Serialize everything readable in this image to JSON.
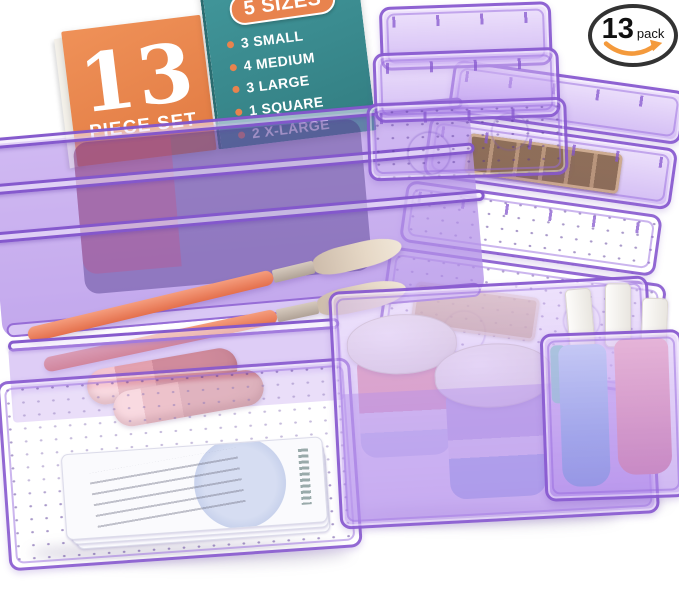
{
  "alt": "13-piece purple clear plastic drawer organizer set holding makeup brushes, lipsticks, cream jars and nail polish",
  "info_card": {
    "number": "13",
    "label": "PIECE SET",
    "sizes_title": "5 SIZES",
    "sizes": [
      "3 SMALL",
      "4 MEDIUM",
      "3 LARGE",
      "1 SQUARE",
      "2 X-LARGE"
    ]
  },
  "pack_badge": {
    "count": "13",
    "unit": "pack"
  },
  "colors": {
    "card_orange": "#E8834E",
    "card_teal": "#3A8A8C",
    "card_text_white": "#FFFFFF",
    "badge_outline": "#333333",
    "badge_smile_orange": "#F49A3C",
    "bin_rim_purple": "#8658CE",
    "bin_fill_purple": "#CFB2F0",
    "bin_shadow_purple": "#5E3FA0",
    "brush_coral": "#EE8363",
    "lipstick_pink": "#E3A1AF",
    "polish_blue": "#7FB4E6",
    "polish_pink": "#EE96A0",
    "jar_lid_white": "#F2EFE9",
    "palette_brown": "#B28B67",
    "background": "#FFFFFF"
  }
}
